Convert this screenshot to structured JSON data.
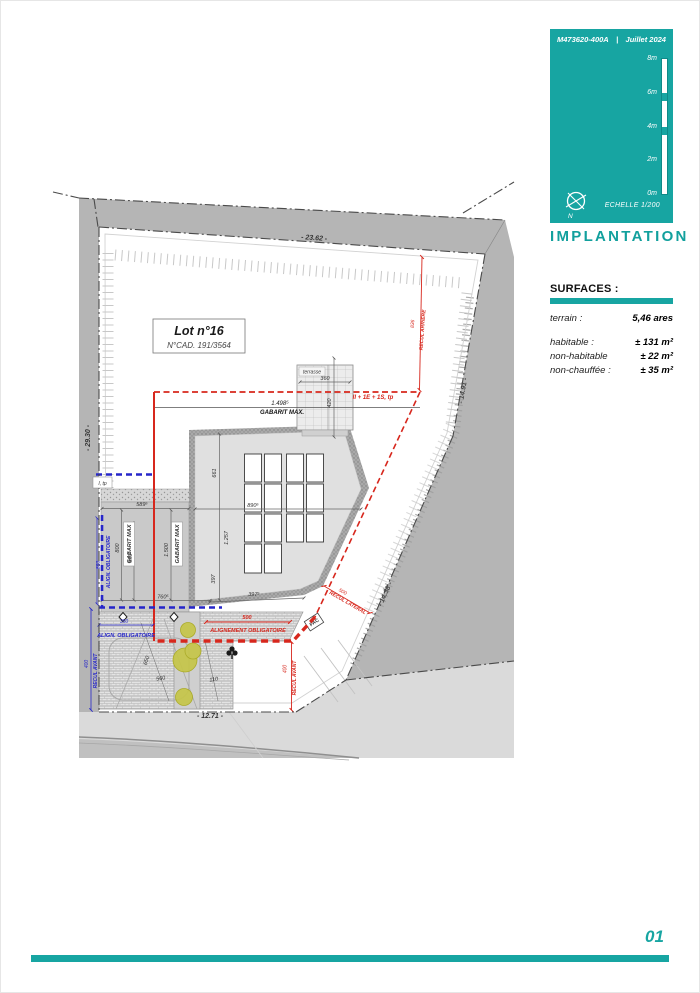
{
  "header": {
    "doc_ref": "M473620-400A",
    "separator": "|",
    "date": "Juillet 2024"
  },
  "scale_panel": {
    "ticks": [
      "8m",
      "6m",
      "4m",
      "2m",
      "0m"
    ],
    "echelle_label": "ECHELLE",
    "echelle_value": "1/200",
    "north_label": "N"
  },
  "title": "IMPLANTATION",
  "surfaces": {
    "heading": "SURFACES :",
    "rows": [
      {
        "label": "terrain :",
        "value": "5,46 ares"
      },
      {
        "label": "habitable :",
        "value": "± 131 m²"
      },
      {
        "label": "non-habitable",
        "value": "± 22 m²"
      },
      {
        "label": "non-chauffée :",
        "value": "± 35 m²"
      }
    ]
  },
  "page_number": "01",
  "plan": {
    "lot": {
      "name": "Lot n°16",
      "cad": "N°CAD. 191/3564"
    },
    "dims": {
      "top": "- 23.62 -",
      "left": "- 29.30 -",
      "right_upper": "- 14.91 -",
      "right_lower": "- 14.38 -",
      "bottom": "- 12.71 -",
      "b661": "661",
      "b1257": "1.257",
      "b397": "397",
      "b890": "890⁵",
      "b397b": "397⁵",
      "b589": "589⁵",
      "b800": "800",
      "b650": "650⁵",
      "b1500": "1.500",
      "b760": "760⁵",
      "t360": "360",
      "t420": "420",
      "d560": "560",
      "d650": "650",
      "d110": "110"
    },
    "red": {
      "recul_arriere_val": "836",
      "recul_arriere": "RECUL ARRIERE",
      "storeys": "II + 1E + 1S, tp",
      "align_val": "500",
      "align": "ALIGNEMENT OBLIGATOIRE",
      "recul_avant_val": "400",
      "recul_avant": "RECUL AVANT",
      "recul_lat_val": "500",
      "recul_lat": "RECUL LATERAL"
    },
    "black": {
      "level": "1.498⁵",
      "gabarit": "GABARIT MAX."
    },
    "blue": {
      "align_v": "ALIGN. OBLIGATOIRE",
      "align_v_val": "850",
      "align_h": "ALIGN. OBLIGATOIRE",
      "align_h_val": "350",
      "recul_avant": "RECUL AVANT",
      "recul_avant_val": "400",
      "itp": "I, tp"
    },
    "labels": {
      "terrasse": "terrasse",
      "pac": "PAC",
      "gabarit_rot": "GABARIT MAX"
    }
  }
}
